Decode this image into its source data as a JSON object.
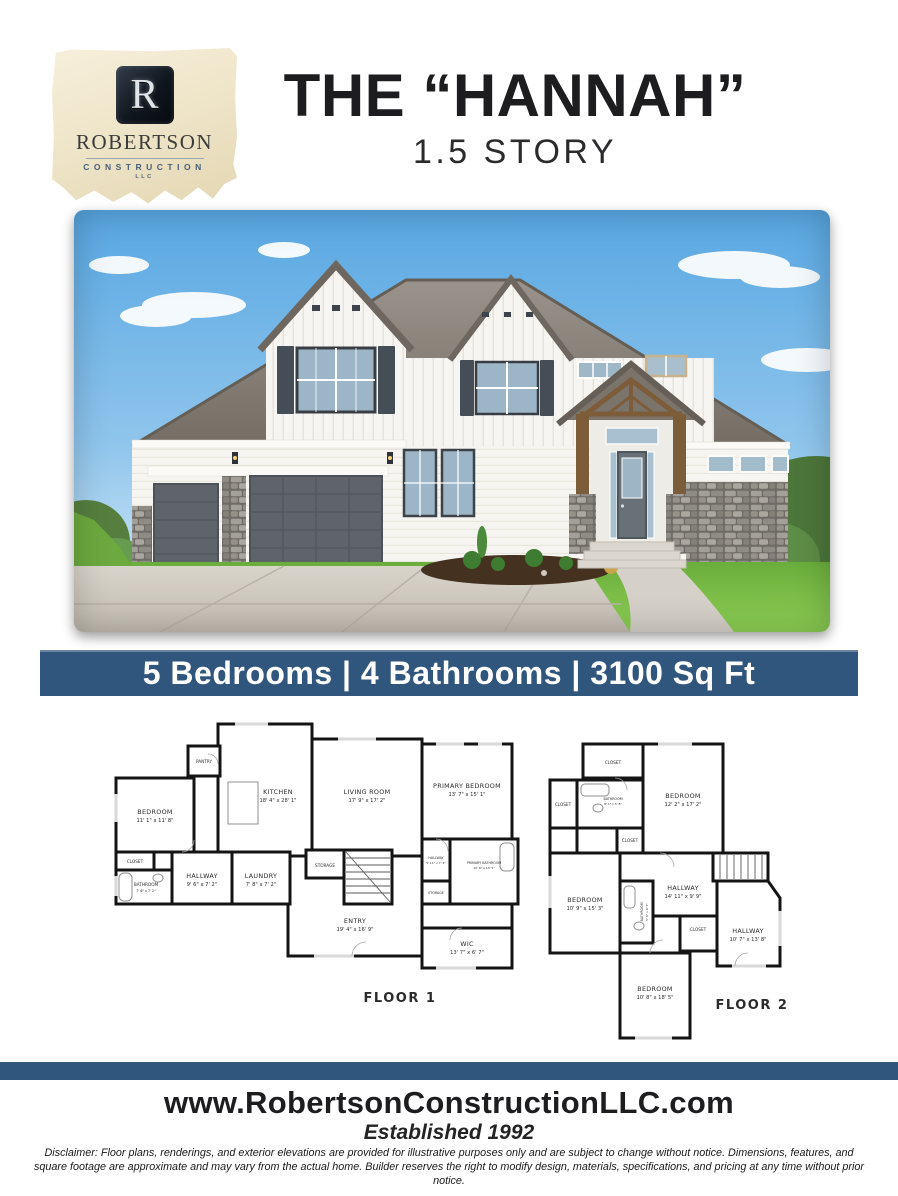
{
  "logo": {
    "monogram": "R",
    "name": "ROBERTSON",
    "division": "CONSTRUCTION",
    "llc": "LLC"
  },
  "header": {
    "title": "THE “HANNAH”",
    "subtitle": "1.5 STORY"
  },
  "banner": {
    "text": "5 Bedrooms | 4 Bathrooms | 3100 Sq Ft"
  },
  "floor_plans": {
    "floor1": {
      "caption": "FLOOR 1",
      "rooms": {
        "pantry": {
          "name": "PANTRY"
        },
        "kitchen": {
          "name": "KITCHEN",
          "dims": "18' 4\" x 28' 1\""
        },
        "bedroom": {
          "name": "BEDROOM",
          "dims": "11' 1\" x 11' 8\""
        },
        "closet": {
          "name": "CLOSET"
        },
        "bathroom": {
          "name": "BATHROOM",
          "dims": "7' 6\" x 7' 2\""
        },
        "hallway": {
          "name": "HALLWAY",
          "dims": "9' 6\" x 7' 2\""
        },
        "laundry": {
          "name": "LAUNDRY",
          "dims": "7' 8\" x 7' 2\""
        },
        "living": {
          "name": "LIVING ROOM",
          "dims": "17' 9\" x 17' 2\""
        },
        "storage_center": {
          "name": "STORAGE"
        },
        "primary_bedroom": {
          "name": "PRIMARY BEDROOM",
          "dims": "13' 7\" x 15' 1\""
        },
        "hallway_small": {
          "name": "HALLWAY",
          "dims": "5' 11\" x 7' 4\""
        },
        "primary_bathroom": {
          "name": "PRIMARY BATHROOM",
          "dims": "10' 8\" x 13' 5\""
        },
        "storage_right": {
          "name": "STORAGE"
        },
        "entry": {
          "name": "ENTRY",
          "dims": "19' 4\" x 16' 9\""
        },
        "wic": {
          "name": "WIC",
          "dims": "13' 7\" x 6' 7\""
        }
      }
    },
    "floor2": {
      "caption": "FLOOR 2",
      "rooms": {
        "closet_top": {
          "name": "CLOSET"
        },
        "bedroom_top": {
          "name": "BEDROOM",
          "dims": "12' 2\" x 17' 2\""
        },
        "closet_left": {
          "name": "CLOSET"
        },
        "bathroom_top": {
          "name": "BATHROOM",
          "dims": "8' 1\" x 5' 8\""
        },
        "closet_mid": {
          "name": "CLOSET"
        },
        "bedroom_left": {
          "name": "BEDROOM",
          "dims": "10' 9\" x 15' 3\""
        },
        "bathroom_mid": {
          "name": "BATHROOM",
          "dims": "5' 6\" x 9' 5\""
        },
        "hallway_upper": {
          "name": "HALLWAY",
          "dims": "14' 11\" x 9' 9\""
        },
        "closet_center": {
          "name": "CLOSET"
        },
        "hallway_right": {
          "name": "HALLWAY",
          "dims": "10' 7\" x 13' 8\""
        },
        "bedroom_bottom": {
          "name": "BEDROOM",
          "dims": "10' 8\" x 18' 5\""
        }
      }
    }
  },
  "footer": {
    "website": "www.RobertsonConstructionLLC.com",
    "established": "Established 1992",
    "disclaimer": "Disclaimer: Floor plans, renderings, and exterior elevations are provided for illustrative purposes only and are subject to change without notice. Dimensions, features, and square footage are approximate and may vary from the actual home. Builder reserves the right to modify design, materials, specifications, and pricing at any time without prior notice."
  },
  "colors": {
    "banner_blue": "#31567d",
    "title_black": "#1d1d1f",
    "parchment": "#efe5c9",
    "logo_navy": "#10161e"
  }
}
